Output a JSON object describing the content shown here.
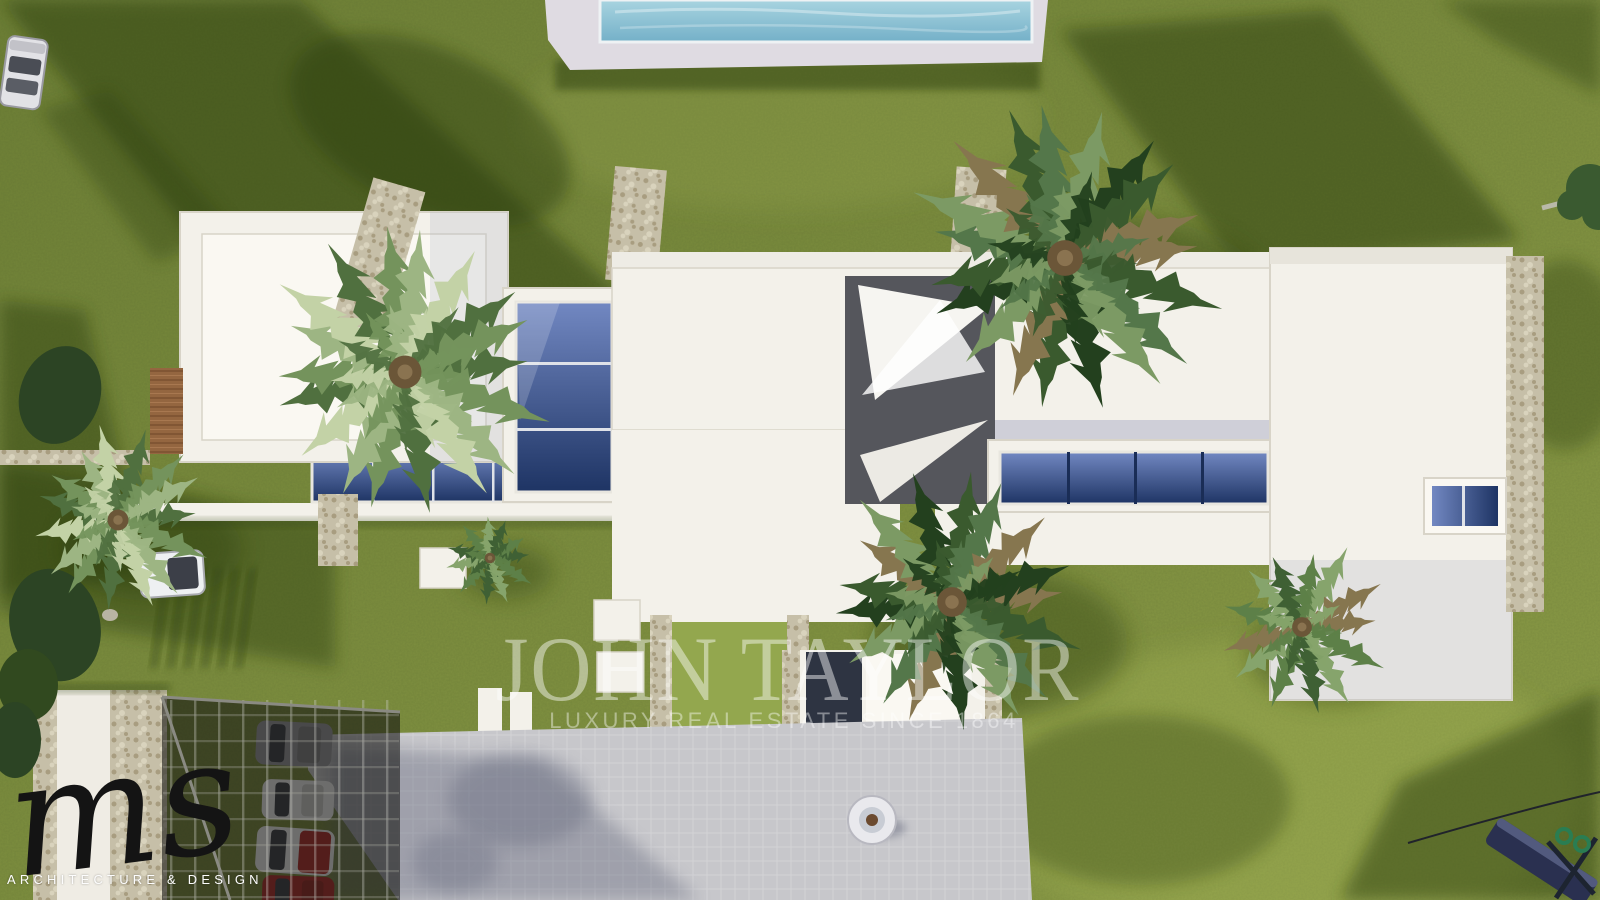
{
  "scene": {
    "watermark": {
      "title": "JOHN TAYLOR",
      "subtitle": "LUXURY REAL ESTATE SINCE 1864"
    },
    "logo": {
      "monogram": "ms",
      "caption": "ARCHITECTURE & DESIGN"
    }
  },
  "colors": {
    "grass_base_dark": "#6e8036",
    "grass_base_light": "#8d9d48",
    "grass_sunlit": "#93a74e",
    "grass_shadow": "#2c3c10",
    "roof_white": "#f3f1ea",
    "roof_bright": "#faf8f2",
    "roof_shade": "#b0b2c4",
    "parapet_line": "#d8d4c8",
    "stone": "#c6bfa8",
    "stone_dark": "#a89d80",
    "stone_light": "#d9d3bd",
    "glass_dark": "#1e3464",
    "glass_light": "#7288c2",
    "pool_water_light": "#a8d4e0",
    "pool_water_dark": "#74b0c8",
    "pool_deck": "#dfdbe2",
    "driveway": "#c7c7cb",
    "drive_shadow": "#5f6478",
    "wood_deck": "#946640",
    "wood_dark": "#7c5230",
    "pergola_dark": "#22221e",
    "palm_dry": "#86764f",
    "palm_core": "#6b5638",
    "car_red": "#b02a28",
    "car_white": "#f0f0f2",
    "car_gray": "#97979d",
    "bench_navy": "#2a3050",
    "frame_green": "#2a7d52",
    "watermark_white": "#ffffff",
    "logo_ink": "#141414"
  }
}
